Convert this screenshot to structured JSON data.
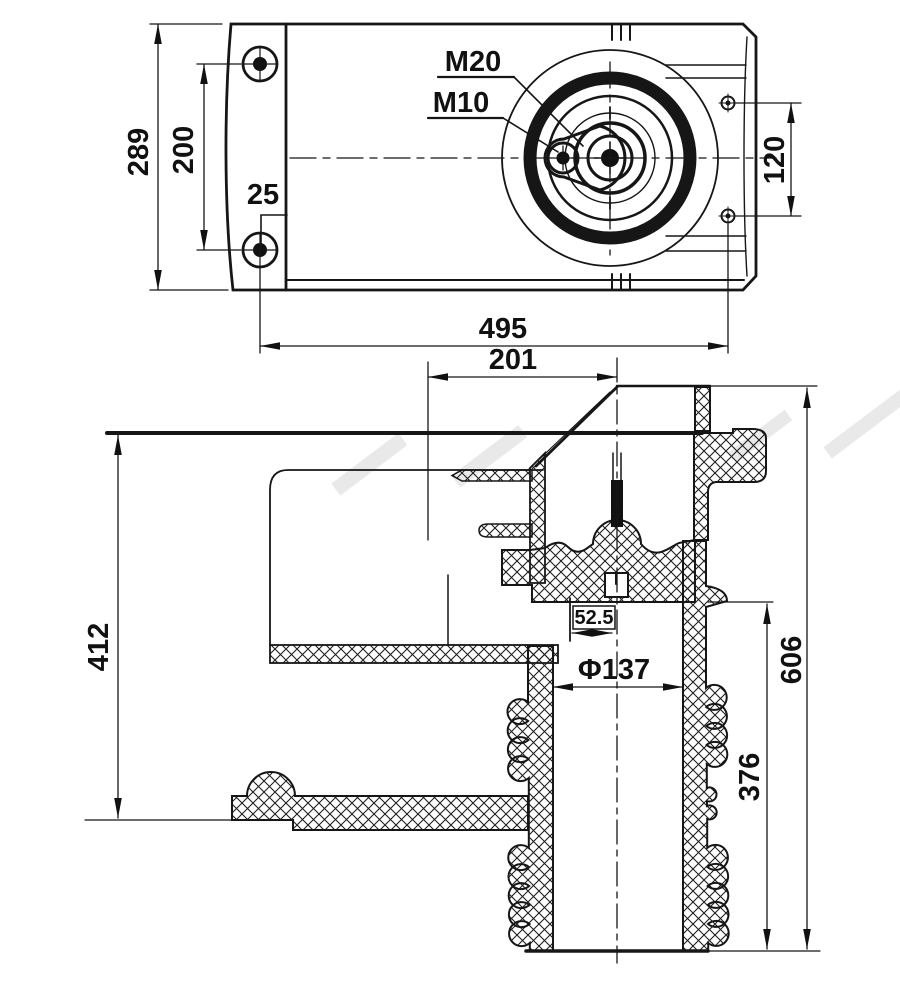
{
  "top_view": {
    "dim_height": "289",
    "dim_bolt_spacing": "200",
    "dim_edge_offset": "25",
    "label_thread_large": "M20",
    "label_thread_small": "M10",
    "dim_side_bolts": "120",
    "dim_width": "495"
  },
  "section_view": {
    "dim_top_offset": "201",
    "dim_left_height": "412",
    "dim_center_offset": "52.5",
    "dim_bore_diameter": "Φ137",
    "dim_skirt_height": "376",
    "dim_total_height": "606"
  }
}
